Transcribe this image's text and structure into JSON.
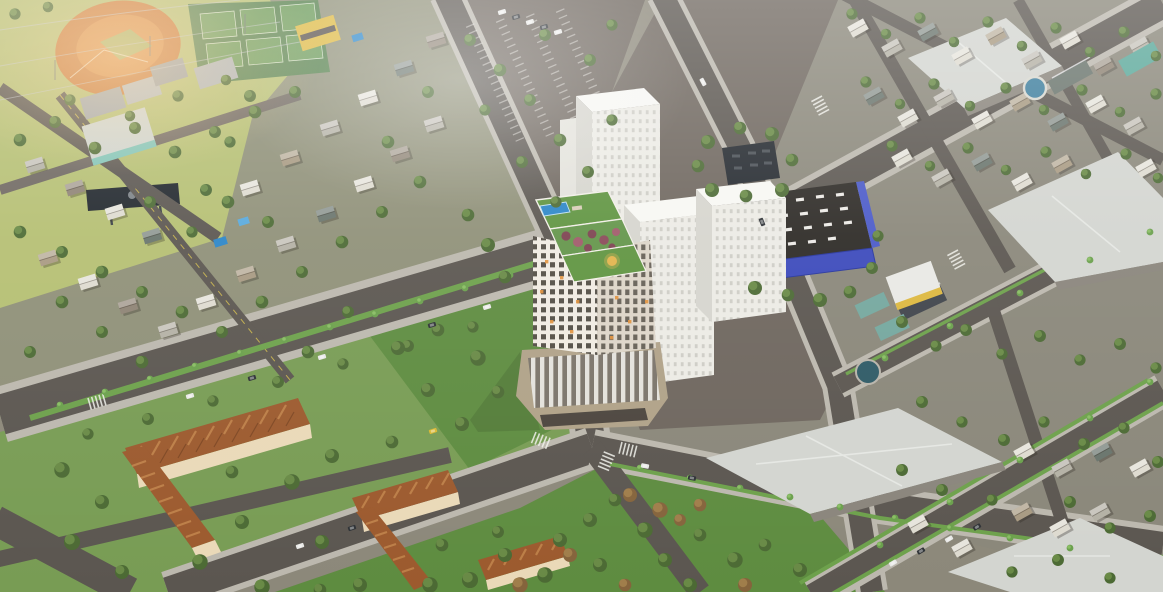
{
  "scene": {
    "type": "aerial-3d-architectural-render",
    "description": "Daytime bird's-eye 3D rendering of an urban residential development: a central high-rise tower with rooftop pool and garden and tan podium, flanked by white apartment slab blocks and a blue commercial building, surrounded by diagonal tree-lined boulevards, a baseball field, tennis courts, a parking lot, green parks with autumn trees, orange-roofed walk-up apartment blocks and low-rise suburban neighborhoods",
    "time_of_day": "daylight with soft haze",
    "visible_text": []
  },
  "landmarks": [
    {
      "id": "central-tower",
      "label": "High-rise tower with rooftop pool, garden terraces and gold emblem"
    },
    {
      "id": "white-slab-blocks",
      "label": "Cluster of white high-rise slab apartment blocks"
    },
    {
      "id": "blue-commercial-building",
      "label": "Blue-walled commercial hall with dark vented roof"
    },
    {
      "id": "baseball-field",
      "label": "Baseball field with orange infield and scoreboard"
    },
    {
      "id": "tennis-courts",
      "label": "Six green tennis courts"
    },
    {
      "id": "parking-lot",
      "label": "Tree-dotted surface parking lot"
    },
    {
      "id": "central-park",
      "label": "Park with green and autumn-colored trees"
    },
    {
      "id": "red-apartment-blocks",
      "label": "Orange-brown gabled walk-up apartment blocks"
    },
    {
      "id": "warehouses",
      "label": "Large light-gray hipped-roof halls"
    },
    {
      "id": "suburban-houses",
      "label": "Low-rise houses with pools and trees"
    }
  ],
  "palette": {
    "ground": "#8c887a",
    "groundLeft": "#8f9078",
    "groundRight": "#8a877a",
    "asphalt": "#5b5650",
    "asphaltLight": "#6e6760",
    "plaza": "#6e665e",
    "sidewalk": "#bcb8ae",
    "fieldGreen": "#b5bf72",
    "infieldOrange": "#cc7a38",
    "infieldCore": "#da8c44",
    "tennisPad": "#55804c",
    "tennisCourt": "#6a9a58",
    "parkGreen": "#5e8c40",
    "lawnGreen": "#74a04e",
    "medianGreen": "#6da14b",
    "treeDark": "#4c6a34",
    "treeLight": "#6f8f4a",
    "autumnDark": "#85643c",
    "autumnLight": "#a5824e",
    "palmGreen": "#6aa04c",
    "towerWhite": "#f0ebe2",
    "towerSide": "#ddd5c8",
    "windowDark": "#423c34",
    "windowLit": "#e2913a",
    "podiumTan": "#b0a288",
    "podiumDark": "#4c453e",
    "glassLight": "#e9e8e3",
    "glassDark": "#767067",
    "roofGarden": "#5f9440",
    "poolBlue": "#2b86c8",
    "poolLight": "#58a9dc",
    "plantingRed": "#7d4250",
    "plantingRedLight": "#a05a6a",
    "goldAccent": "#e2b44c",
    "slabWhite": "#ecebe5",
    "slabTop": "#f7f7f3",
    "slabSide": "#d6d5ce",
    "slabWin": "#c6c5be",
    "blueWall": "#3b49bb",
    "blueWallDark": "#27359c",
    "darkRoof": "#2c2925",
    "darkBuilding": "#23282e",
    "ventWhite": "#eceae6",
    "warehouseRoof": "#d3d5d0",
    "warehouseRidge": "#e7e9e4",
    "wallShadow": "#8a857c",
    "redRoof": "#9c5a2e",
    "redRoofLight": "#c2854c",
    "redRoofDark": "#73401f",
    "creamWall": "#ead9b8",
    "blueWindow": "#5a7fae",
    "yellowWall": "#ddb83f",
    "tealRoof": "#74a79e",
    "houseGray": "#b4b1a5",
    "houseBrown": "#8e8374",
    "houseWhite": "#dedbd0",
    "houseSlate": "#69746c",
    "houseTan": "#a89a82",
    "carWhite": "#e8e8e6",
    "carDark": "#2e3236",
    "carYellow": "#d9b832",
    "scoreboard": "#20262c",
    "powerLine": "#c4c9cf",
    "hazeWarm": "#ffd9a0"
  }
}
